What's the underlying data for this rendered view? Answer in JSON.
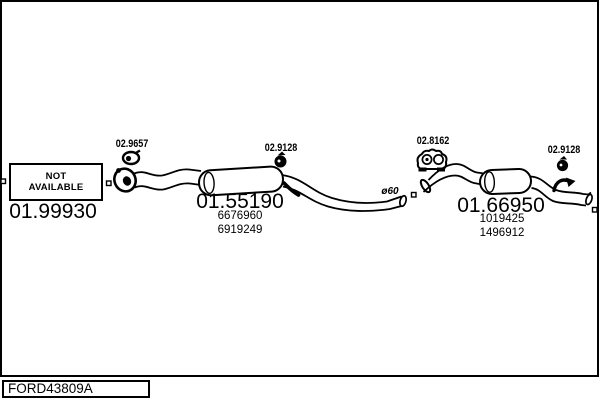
{
  "diagram": {
    "background": "#ffffff",
    "ink": "#000000",
    "footer_code": "FORD43809A",
    "not_available": {
      "line1": "NOT",
      "line2": "AVAILABLE"
    },
    "front_section": {
      "part_number": "01.99930"
    },
    "centre_section": {
      "part_number": "01.55190",
      "oem_numbers": [
        "6676960",
        "6919249"
      ]
    },
    "rear_section": {
      "part_number": "01.66950",
      "oem_numbers": [
        "1019425",
        "1496912"
      ]
    },
    "fittings": {
      "front_clamp": "02.9657",
      "centre_clamp": "02.9128",
      "rear_hanger": "02.8162",
      "rear_clamp": "02.9128"
    },
    "pipe_diameter_label": "ø60"
  }
}
